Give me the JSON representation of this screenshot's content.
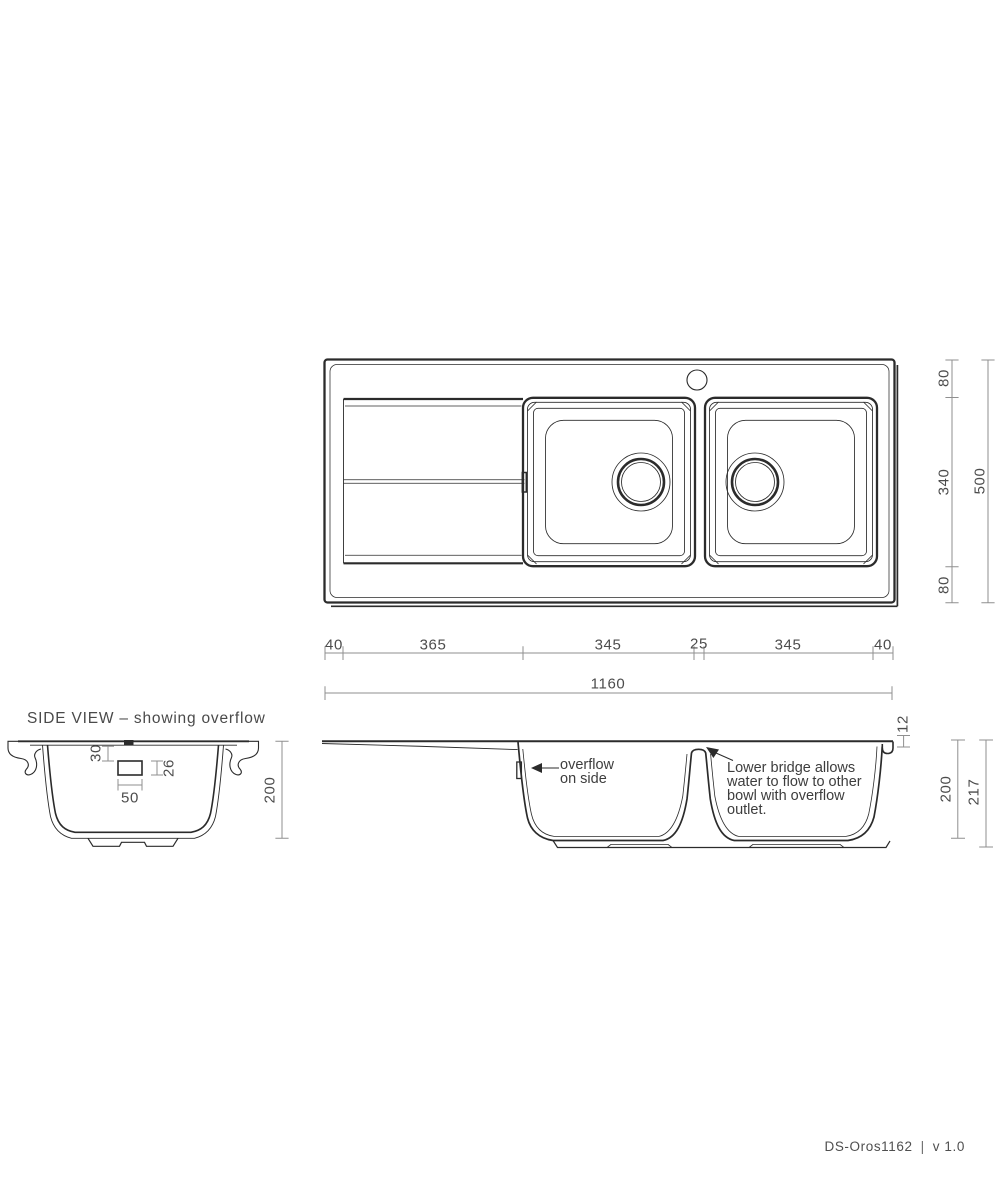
{
  "meta": {
    "side_view_title": "SIDE VIEW – showing overflow",
    "footer_code": "DS-Oros1162",
    "footer_divider": "|",
    "footer_version": "v 1.0"
  },
  "top_view": {
    "width_segments": [
      "40",
      "365",
      "345",
      "25",
      "345",
      "40"
    ],
    "width_overall": "1160",
    "depth_segments": [
      "80",
      "340",
      "80"
    ],
    "depth_overall": "500"
  },
  "side_view_detail": {
    "overflow_from_rim": "30",
    "overflow_height": "26",
    "overflow_width": "50",
    "bowl_depth": "200"
  },
  "side_view_full": {
    "overflow_label": [
      "overflow",
      "on side"
    ],
    "bridge_label": [
      "Lower bridge allows",
      "water to flow to other",
      "bowl with overflow",
      "outlet."
    ],
    "rim_height": "12",
    "bowl_depth": "200",
    "overall_height": "217"
  }
}
